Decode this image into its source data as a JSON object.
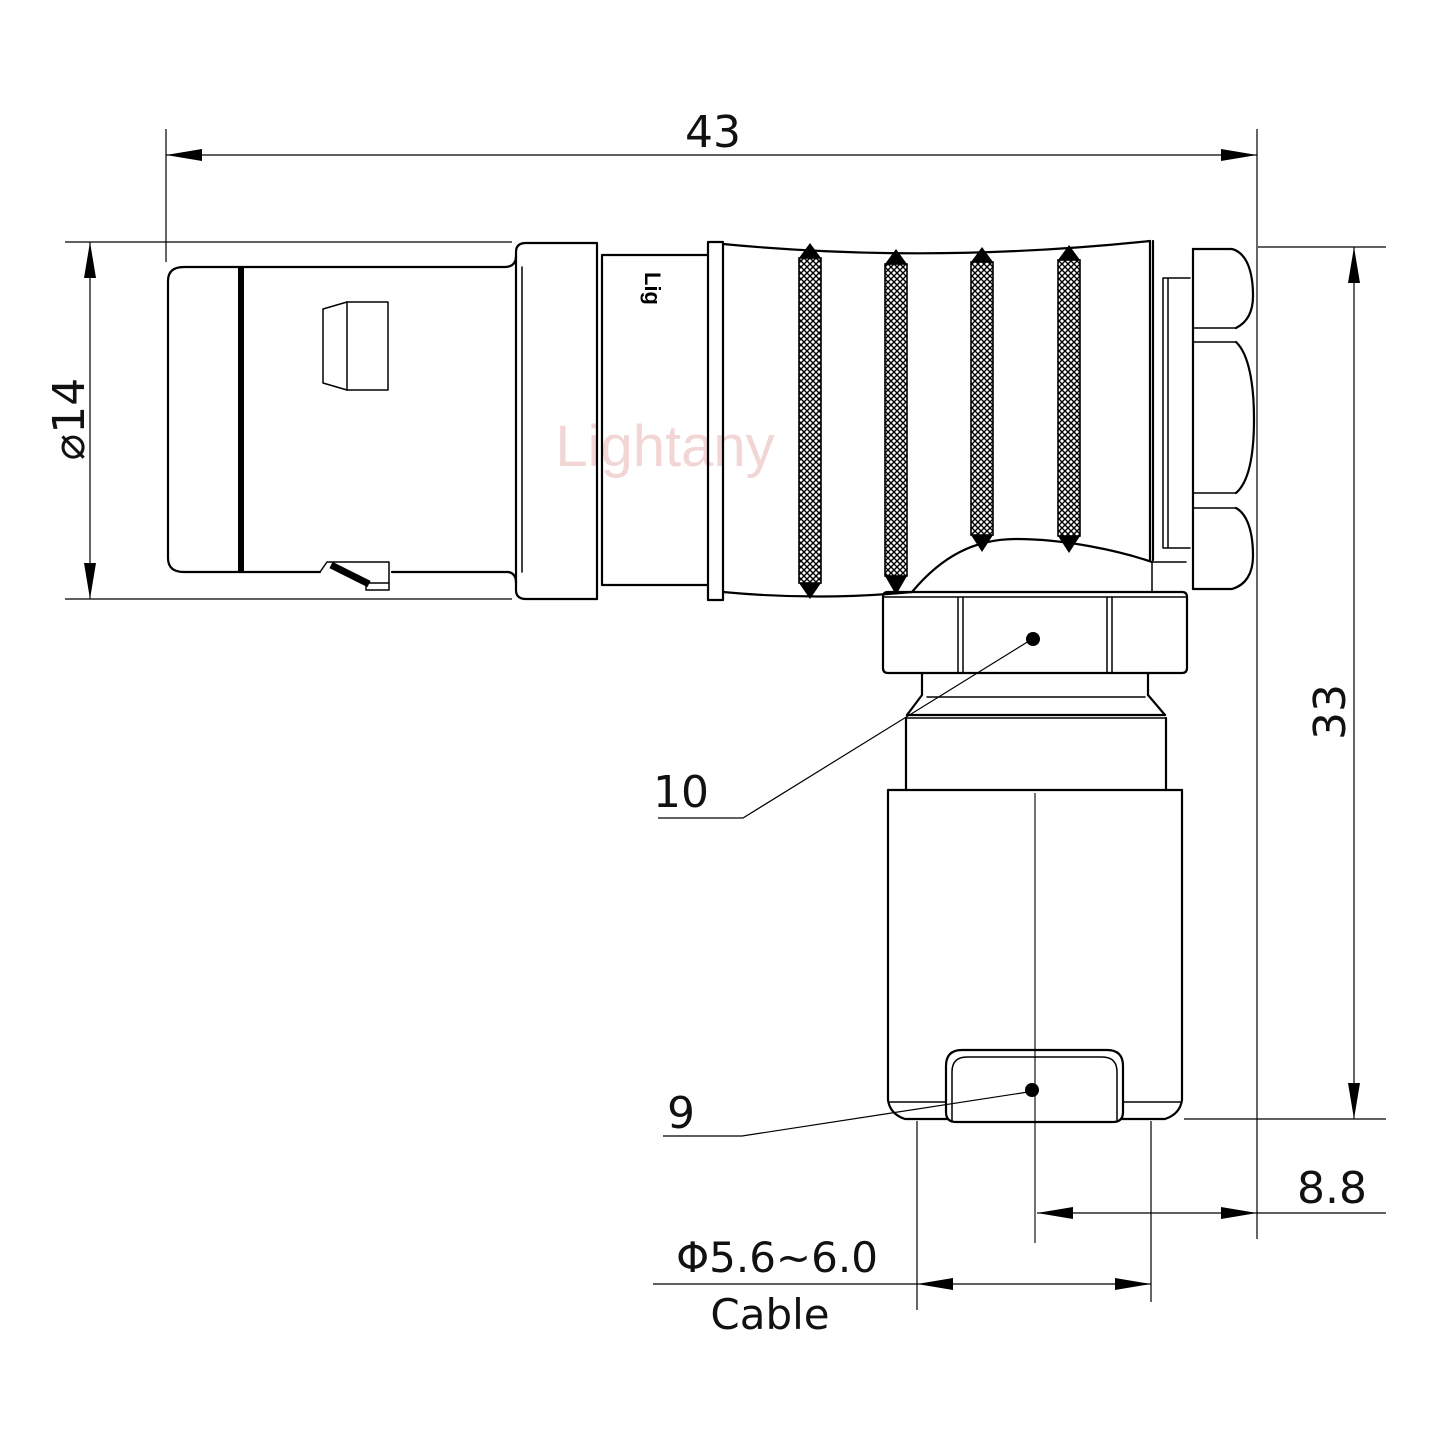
{
  "drawing": {
    "kind": "connector-technical-drawing",
    "view": "right-angle elbow plug, side view with dimensions",
    "watermark": "Lightany",
    "engraving": "Lig",
    "dimensions": {
      "overall_length": "43",
      "body_diameter": "⌀14",
      "overall_height": "33",
      "center_to_face": "8.8",
      "cable_diameter": "Φ5.6~6.0",
      "cable_label": "Cable"
    },
    "callouts": {
      "coupling_nut": "10",
      "cable_clamp": "9"
    },
    "colors": {
      "line": "#000000",
      "watermark": "#e8b6b6",
      "background": "#ffffff"
    }
  }
}
